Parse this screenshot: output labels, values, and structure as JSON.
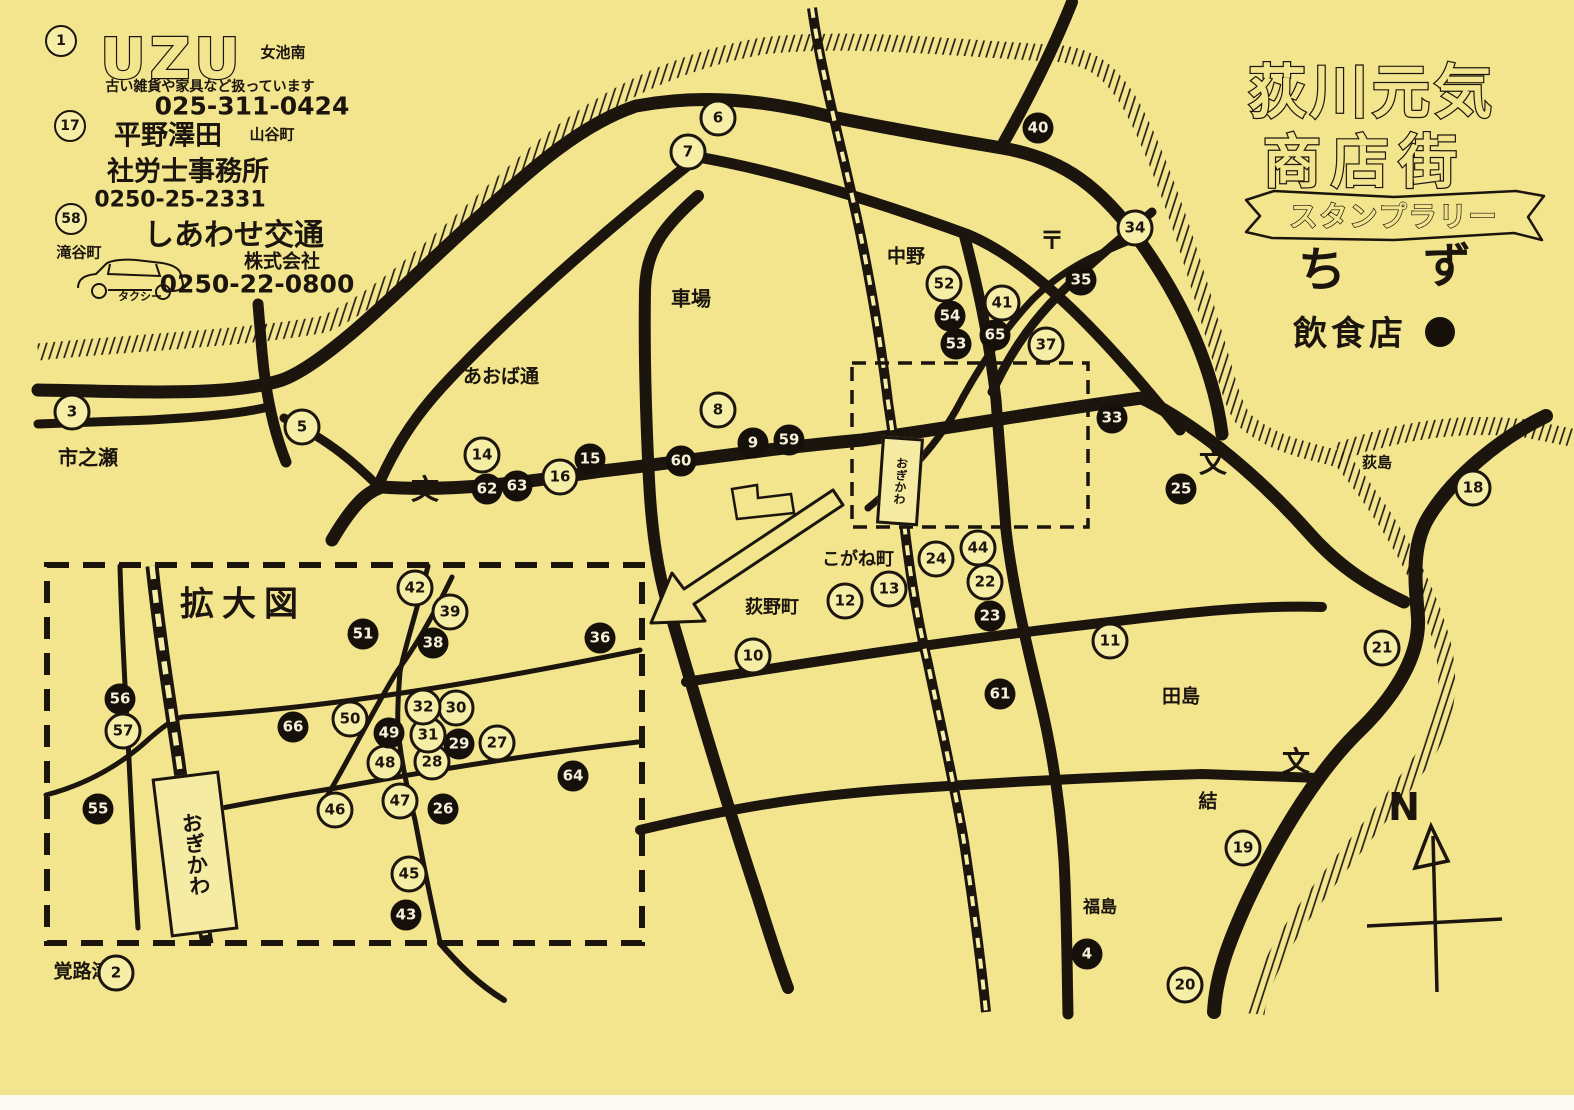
{
  "paper": "#f2e58d",
  "ink": "#1b150e",
  "title": {
    "line1": "荻川元気",
    "line2": "商店街",
    "ribbon": "スタンプラリー",
    "chi": "ち",
    "zu": "ず",
    "legend_text": "飲食店"
  },
  "ads": [
    {
      "num": "1",
      "logo": "UZU",
      "area": "女池南",
      "desc": "古い雑貨や家具など扱っています",
      "phone": "025-311-0424"
    },
    {
      "num": "17",
      "name": "平野澤田",
      "area": "山谷町",
      "name2": "社労士事務所",
      "phone": "0250-25-2331"
    },
    {
      "num": "58",
      "name": "しあわせ交通",
      "corp": "株式会社",
      "area": "滝谷町",
      "vehicle": "タクシー",
      "phone": "0250-22-0800"
    }
  ],
  "compass": {
    "letter": "N"
  },
  "stations": [
    {
      "name": "おぎかわ",
      "x": 897,
      "y": 478,
      "w": 36,
      "h": 82,
      "fs": 12,
      "rot": 4
    },
    {
      "name": "おぎかわ",
      "x": 192,
      "y": 851,
      "w": 62,
      "h": 154,
      "fs": 21,
      "rot": -7
    }
  ],
  "labels": [
    {
      "id": "ichinose",
      "t": "市之瀬",
      "x": 88,
      "y": 456,
      "s": 20
    },
    {
      "id": "aoba-dori",
      "t": "あおば通",
      "x": 501,
      "y": 375,
      "s": 19
    },
    {
      "id": "shaba",
      "t": "車場",
      "x": 691,
      "y": 297,
      "s": 20
    },
    {
      "id": "nakano",
      "t": "中野",
      "x": 906,
      "y": 255,
      "s": 19
    },
    {
      "id": "post-mark",
      "t": "〒",
      "x": 1052,
      "y": 238,
      "s": 24
    },
    {
      "id": "kogane-cho",
      "t": "こがね町",
      "x": 858,
      "y": 558,
      "s": 18
    },
    {
      "id": "ogino-machi",
      "t": "荻野町",
      "x": 772,
      "y": 606,
      "s": 18
    },
    {
      "id": "tajima",
      "t": "田島",
      "x": 1181,
      "y": 695,
      "s": 19
    },
    {
      "id": "yui",
      "t": "結",
      "x": 1208,
      "y": 800,
      "s": 19
    },
    {
      "id": "fukushima",
      "t": "福島",
      "x": 1100,
      "y": 905,
      "s": 17
    },
    {
      "id": "kakurozu",
      "t": "覚路津",
      "x": 82,
      "y": 970,
      "s": 19
    },
    {
      "id": "ogishima",
      "t": "荻島",
      "x": 1377,
      "y": 462,
      "s": 15,
      "bg": 1
    },
    {
      "id": "kakudai-zu",
      "t": "拡大図",
      "x": 243,
      "y": 601,
      "s": 34,
      "ls": 8
    },
    {
      "id": "school-1",
      "t": "文",
      "x": 425,
      "y": 488,
      "s": 28
    },
    {
      "id": "school-2",
      "t": "文",
      "x": 1213,
      "y": 461,
      "s": 28
    },
    {
      "id": "school-3",
      "t": "文",
      "x": 1296,
      "y": 760,
      "s": 28
    }
  ],
  "markers": [
    {
      "n": 1,
      "x": 61,
      "y": 41,
      "f": 0,
      "ad": 1
    },
    {
      "n": 2,
      "x": 116,
      "y": 973,
      "f": 0
    },
    {
      "n": 3,
      "x": 72,
      "y": 412,
      "f": 0
    },
    {
      "n": 4,
      "x": 1087,
      "y": 954,
      "f": 1
    },
    {
      "n": 5,
      "x": 302,
      "y": 427,
      "f": 0
    },
    {
      "n": 6,
      "x": 718,
      "y": 118,
      "f": 0
    },
    {
      "n": 7,
      "x": 688,
      "y": 152,
      "f": 0
    },
    {
      "n": 8,
      "x": 718,
      "y": 410,
      "f": 0
    },
    {
      "n": 9,
      "x": 753,
      "y": 443,
      "f": 1
    },
    {
      "n": 10,
      "x": 753,
      "y": 656,
      "f": 0
    },
    {
      "n": 11,
      "x": 1110,
      "y": 641,
      "f": 0
    },
    {
      "n": 12,
      "x": 845,
      "y": 601,
      "f": 0
    },
    {
      "n": 13,
      "x": 889,
      "y": 589,
      "f": 0
    },
    {
      "n": 14,
      "x": 482,
      "y": 455,
      "f": 0
    },
    {
      "n": 15,
      "x": 590,
      "y": 459,
      "f": 1
    },
    {
      "n": 16,
      "x": 560,
      "y": 477,
      "f": 0
    },
    {
      "n": 17,
      "x": 70,
      "y": 126,
      "f": 0,
      "ad": 1
    },
    {
      "n": 18,
      "x": 1473,
      "y": 488,
      "f": 0
    },
    {
      "n": 19,
      "x": 1243,
      "y": 848,
      "f": 0
    },
    {
      "n": 20,
      "x": 1185,
      "y": 985,
      "f": 0
    },
    {
      "n": 21,
      "x": 1382,
      "y": 648,
      "f": 0
    },
    {
      "n": 22,
      "x": 985,
      "y": 582,
      "f": 0
    },
    {
      "n": 23,
      "x": 990,
      "y": 616,
      "f": 1
    },
    {
      "n": 24,
      "x": 936,
      "y": 559,
      "f": 0
    },
    {
      "n": 25,
      "x": 1181,
      "y": 489,
      "f": 1
    },
    {
      "n": 26,
      "x": 443,
      "y": 809,
      "f": 1
    },
    {
      "n": 27,
      "x": 497,
      "y": 743,
      "f": 0
    },
    {
      "n": 28,
      "x": 432,
      "y": 762,
      "f": 0
    },
    {
      "n": 29,
      "x": 459,
      "y": 744,
      "f": 1
    },
    {
      "n": 30,
      "x": 456,
      "y": 708,
      "f": 0
    },
    {
      "n": 31,
      "x": 428,
      "y": 735,
      "f": 0
    },
    {
      "n": 32,
      "x": 423,
      "y": 707,
      "f": 0
    },
    {
      "n": 33,
      "x": 1112,
      "y": 418,
      "f": 1
    },
    {
      "n": 34,
      "x": 1135,
      "y": 228,
      "f": 0
    },
    {
      "n": 35,
      "x": 1081,
      "y": 280,
      "f": 1
    },
    {
      "n": 36,
      "x": 600,
      "y": 638,
      "f": 1
    },
    {
      "n": 37,
      "x": 1046,
      "y": 345,
      "f": 0
    },
    {
      "n": 38,
      "x": 433,
      "y": 643,
      "f": 1
    },
    {
      "n": 39,
      "x": 450,
      "y": 612,
      "f": 0
    },
    {
      "n": 40,
      "x": 1038,
      "y": 128,
      "f": 1
    },
    {
      "n": 41,
      "x": 1002,
      "y": 303,
      "f": 0
    },
    {
      "n": 42,
      "x": 415,
      "y": 588,
      "f": 0
    },
    {
      "n": 43,
      "x": 406,
      "y": 915,
      "f": 1
    },
    {
      "n": 44,
      "x": 978,
      "y": 548,
      "f": 0
    },
    {
      "n": 45,
      "x": 409,
      "y": 874,
      "f": 0
    },
    {
      "n": 46,
      "x": 335,
      "y": 810,
      "f": 0
    },
    {
      "n": 47,
      "x": 400,
      "y": 801,
      "f": 0
    },
    {
      "n": 48,
      "x": 385,
      "y": 763,
      "f": 0
    },
    {
      "n": 49,
      "x": 389,
      "y": 733,
      "f": 1
    },
    {
      "n": 50,
      "x": 350,
      "y": 719,
      "f": 0
    },
    {
      "n": 51,
      "x": 363,
      "y": 634,
      "f": 1
    },
    {
      "n": 52,
      "x": 944,
      "y": 284,
      "f": 0
    },
    {
      "n": 53,
      "x": 956,
      "y": 344,
      "f": 1
    },
    {
      "n": 54,
      "x": 950,
      "y": 316,
      "f": 1
    },
    {
      "n": 55,
      "x": 98,
      "y": 809,
      "f": 1
    },
    {
      "n": 56,
      "x": 120,
      "y": 699,
      "f": 1
    },
    {
      "n": 57,
      "x": 123,
      "y": 731,
      "f": 0
    },
    {
      "n": 58,
      "x": 71,
      "y": 219,
      "f": 0,
      "ad": 1
    },
    {
      "n": 59,
      "x": 789,
      "y": 440,
      "f": 1
    },
    {
      "n": 60,
      "x": 681,
      "y": 461,
      "f": 1
    },
    {
      "n": 61,
      "x": 1000,
      "y": 694,
      "f": 1
    },
    {
      "n": 62,
      "x": 487,
      "y": 489,
      "f": 1
    },
    {
      "n": 63,
      "x": 517,
      "y": 486,
      "f": 1
    },
    {
      "n": 64,
      "x": 573,
      "y": 776,
      "f": 1
    },
    {
      "n": 65,
      "x": 995,
      "y": 335,
      "f": 1
    },
    {
      "n": 66,
      "x": 293,
      "y": 727,
      "f": 1
    }
  ]
}
